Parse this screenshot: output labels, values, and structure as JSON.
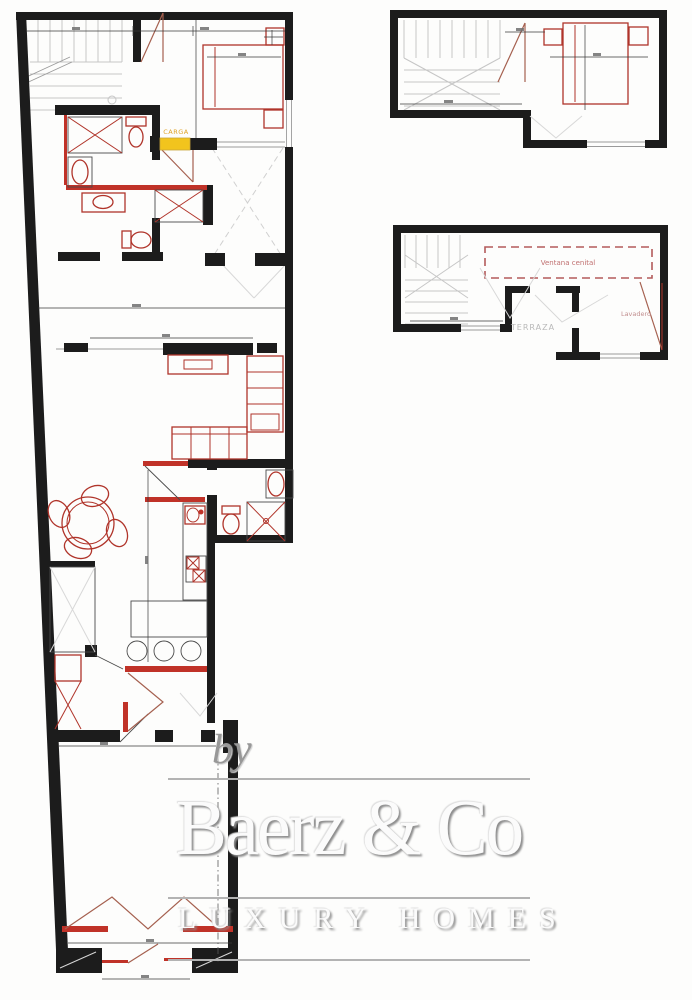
{
  "document": {
    "kind": "architectural floor plan, scanned",
    "accent_colors": {
      "wall_black": "#1c1c1c",
      "fixture_red": "#b0342a",
      "filled_red_wall": "#c03228",
      "door_brown": "#a5604f",
      "carga_yellow": "#f2c41d",
      "carga_text_orange": "#dfa32a",
      "stairs_gray": "#c6c6c6",
      "watermark_gray": "#989898"
    }
  },
  "plans": {
    "main": {
      "title": "main-long-floor-plan",
      "labels": {
        "carga": "CARGA"
      }
    },
    "upper": {
      "title": "upper-level-bedroom-plan",
      "labels": {}
    },
    "terrace": {
      "title": "terrace-level-plan",
      "labels": {
        "skylight": "Ventana cenital",
        "terrace": "TERRAZA",
        "laundry": "Lavadero"
      }
    }
  },
  "watermark": {
    "prefix": "by",
    "brand": "Baerz & Co",
    "tagline": "LUXURY HOMES"
  }
}
